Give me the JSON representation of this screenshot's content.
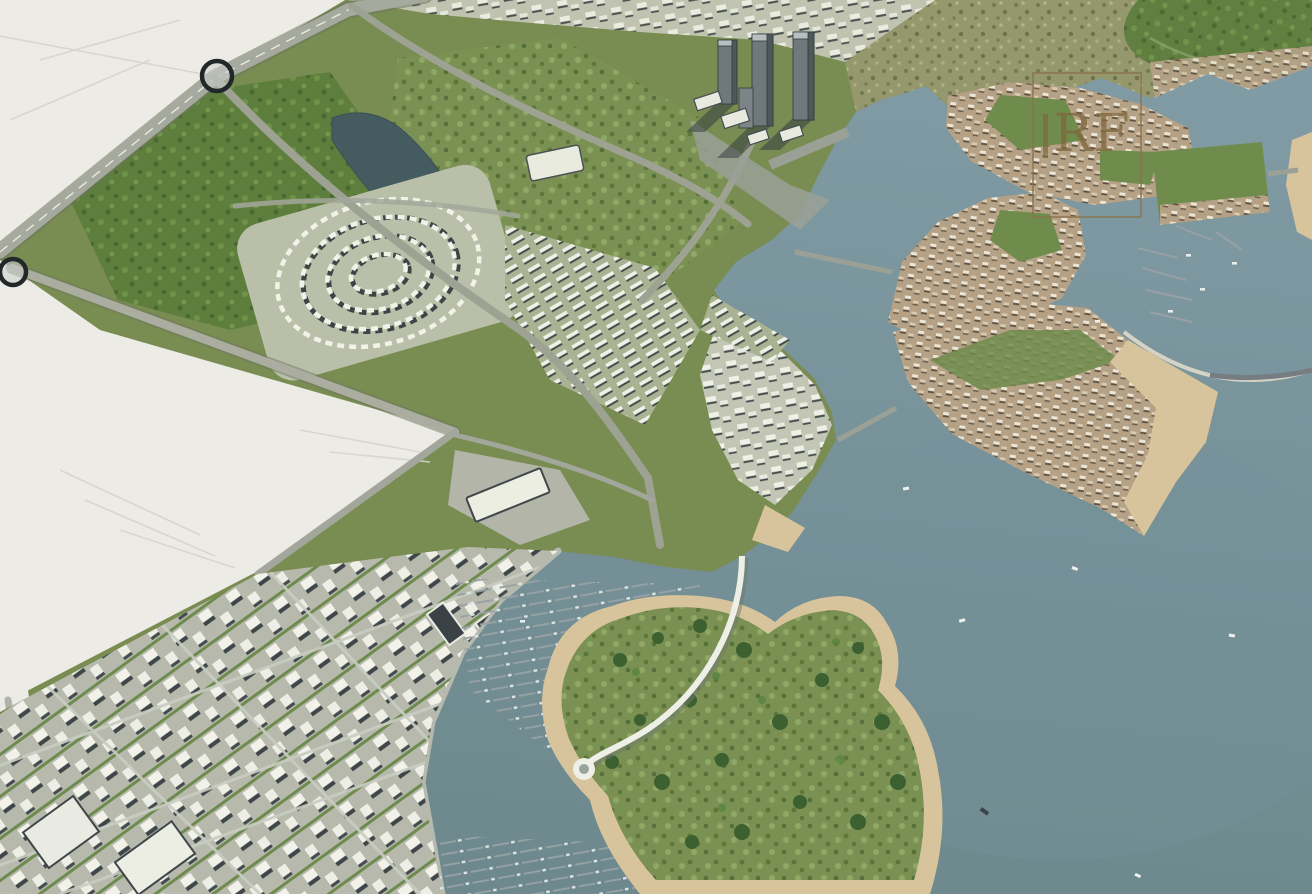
{
  "canvas": {
    "width": 1312,
    "height": 894
  },
  "watermark": {
    "letters": "RF"
  },
  "palette": {
    "water": "#829ca6",
    "water_deep": "#6d898d",
    "desert": "#edebe5",
    "parkland": "#5e7e3e",
    "golf_green": "#7b9154",
    "scrubland": "#95976d",
    "road": "#a3a79b",
    "white_building": "#f2f2ea",
    "roof_shadow": "#454d50",
    "tan_villa": "#b5a186",
    "sand": "#d8c49c",
    "tower": "#70787b",
    "lake": "#445b60",
    "marker_ring": "#22272a",
    "watermark_bronze": "#8a744e"
  },
  "scene": {
    "type": "aerial-3d-masterplan-render",
    "features": [
      {
        "name": "desert-plots",
        "label": "undeveloped-desert-parcels"
      },
      {
        "name": "highway-roundabouts",
        "label": "highway-with-two-ring-markers"
      },
      {
        "name": "spiral-district",
        "label": "spiral-residential-district"
      },
      {
        "name": "central-park-golf",
        "label": "central-parkland-and-golf-greens"
      },
      {
        "name": "cbd-towers",
        "label": "high-rise-tower-cluster"
      },
      {
        "name": "downtown-grid",
        "label": "downtown-street-grid-district"
      },
      {
        "name": "marina",
        "label": "marina-basin-with-piers-and-boats"
      },
      {
        "name": "leisure-island",
        "label": "leisure-island-with-loop-road"
      },
      {
        "name": "villa-islands",
        "label": "fan-shaped-villa-islands"
      },
      {
        "name": "circular-bay",
        "label": "circular-marina-bay-with-causeway"
      },
      {
        "name": "beaches",
        "label": "sand-beaches"
      },
      {
        "name": "sea",
        "label": "open-sea-with-boats"
      }
    ]
  }
}
